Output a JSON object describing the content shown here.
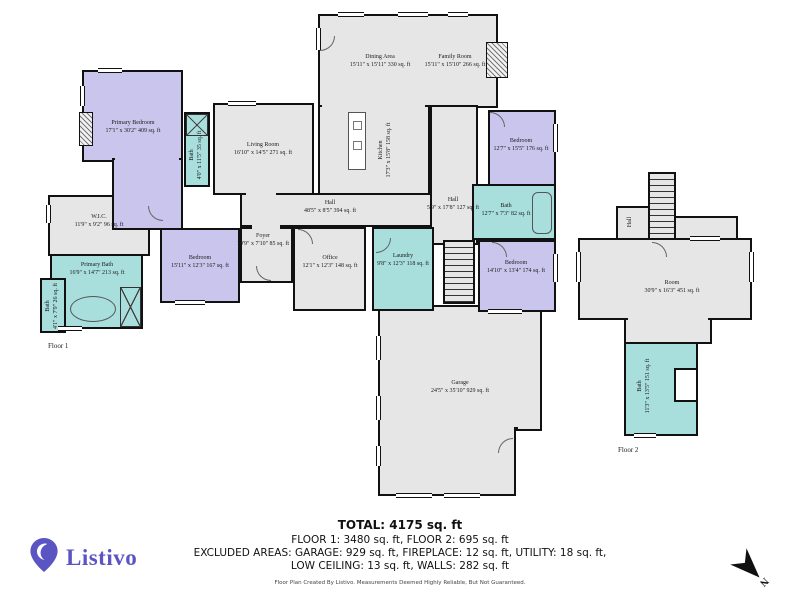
{
  "branding": {
    "logo_text": "Listivo"
  },
  "floor_tags": {
    "floor1": "Floor 1",
    "floor2": "Floor 2"
  },
  "rooms": {
    "primary_bedroom": {
      "name": "Primary Bedroom",
      "dims": "17'1\" x 30'2\" 409 sq. ft"
    },
    "bath_upper": {
      "name": "Bath",
      "dims": "4'0\" x 11'5\" 35 sq. ft"
    },
    "living_room": {
      "name": "Living Room",
      "dims": "16'10\" x 14'5\" 271 sq. ft"
    },
    "dining_area": {
      "name": "Dining Area",
      "dims": "15'11\" x 15'11\" 330 sq. ft"
    },
    "family_room": {
      "name": "Family Room",
      "dims": "15'11\" x 15'10\" 266 sq. ft"
    },
    "kitchen": {
      "name": "Kitchen",
      "dims": "17'3\" x 15'8\" 158 sq. ft"
    },
    "wic": {
      "name": "W.I.C.",
      "dims": "11'9\" x 9'2\" 96 sq. ft"
    },
    "bedroom_left": {
      "name": "Bedroom",
      "dims": "15'11\" x 12'3\" 167 sq. ft"
    },
    "primary_bath": {
      "name": "Primary Bath",
      "dims": "16'9\" x 14'7\" 213 sq. ft"
    },
    "bath_left": {
      "name": "Bath",
      "dims": "4'1\" x 7'9\" 26 sq. ft"
    },
    "hall_main": {
      "name": "Hall",
      "dims": "48'5\" x 8'5\" 394 sq. ft"
    },
    "foyer": {
      "name": "Foyer",
      "dims": "10'9\" x 7'10\" 85 sq. ft"
    },
    "office": {
      "name": "Office",
      "dims": "12'1\" x 12'3\" 148 sq. ft"
    },
    "laundry": {
      "name": "Laundry",
      "dims": "9'8\" x 12'3\" 118 sq. ft"
    },
    "hall_right": {
      "name": "Hall",
      "dims": "5'9\" x 17'8\" 127 sq. ft"
    },
    "bedroom_top_right": {
      "name": "Bedroom",
      "dims": "12'7\" x 15'5\" 176 sq. ft"
    },
    "bath_right": {
      "name": "Bath",
      "dims": "12'7\" x 7'3\" 82 sq. ft"
    },
    "bedroom_right": {
      "name": "Bedroom",
      "dims": "14'10\" x 13'4\" 174 sq. ft"
    },
    "garage": {
      "name": "Garage",
      "dims": "24'5\" x 35'10\" 929 sq. ft"
    },
    "room_f2": {
      "name": "Room",
      "dims": "30'9\" x 16'3\" 451 sq. ft"
    },
    "bath_f2": {
      "name": "Bath",
      "dims": "11'3\" x 13'5\" 151 sq. ft"
    },
    "hall_f2": {
      "name": "Hall",
      "dims": ""
    }
  },
  "summary": {
    "total": "TOTAL: 4175 sq. ft",
    "floors": "FLOOR 1: 3480 sq. ft, FLOOR 2: 695 sq. ft",
    "excluded_line1": "EXCLUDED AREAS: GARAGE: 929 sq. ft, FIREPLACE: 12 sq. ft, UTILITY: 18 sq. ft,",
    "excluded_line2": "LOW CEILING: 13 sq. ft, WALLS: 282 sq. ft",
    "disclaimer": "Floor Plan Created By Listivo. Measurements Deemed Highly Reliable, But Not Guaranteed."
  },
  "colors": {
    "bedroom_fill": "#cac5ec",
    "bath_fill": "#a8dedc",
    "room_fill": "#e6e6e6",
    "wall": "#111111",
    "brand": "#5b55c4"
  }
}
